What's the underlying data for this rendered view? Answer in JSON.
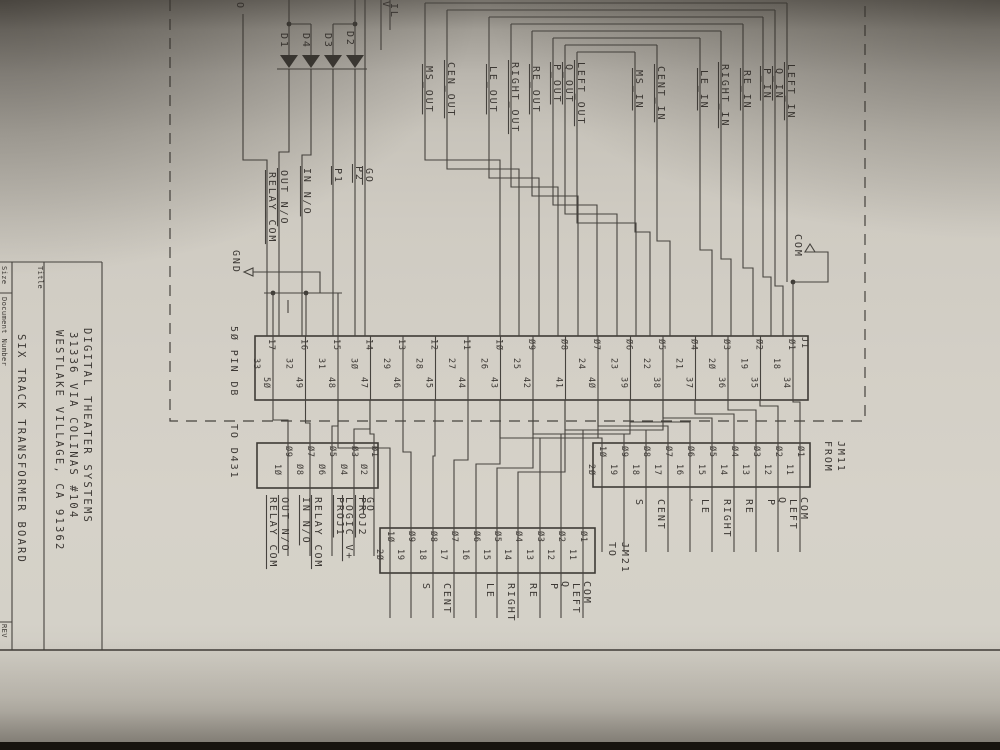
{
  "photo": {
    "paper_color": "#cfcbc2",
    "ink_color": "#45423e",
    "background_color": "#17140f"
  },
  "title_block": {
    "title_label": "Title",
    "size_label": "Size",
    "document_number_label": "Document Number",
    "rev_label": "REV",
    "company_line1": "DIGITAL THEATER SYSTEMS",
    "company_line2": "31336 VIA COLINAS #104",
    "company_line3": "WESTLAKE VILLAGE, CA 91362",
    "title": "SIX TRACK TRANSFORMER BOARD"
  },
  "edge_partial_labels": {
    "left": "O",
    "mid": "V",
    "right": "IL"
  },
  "power": {
    "gnd": "GND",
    "com": "COM"
  },
  "diodes": [
    "D1",
    "D4",
    "D3",
    "D2"
  ],
  "relay_nets": [
    "RELAY_COM",
    "OUT_N/O",
    "IN_N/O",
    "P1",
    "P2",
    "GO"
  ],
  "out_nets": [
    "MS_OUT",
    "CEN_OUT",
    "LE_OUT",
    "RIGHT_OUT",
    "RE_OUT",
    "P_OUT",
    "Q_OUT",
    "LEFT_OUT"
  ],
  "in_nets": [
    "MS_IN",
    "CENT_IN",
    "LE_IN",
    "RIGHT_IN",
    "RE_IN",
    "P_IN",
    "Q_IN",
    "LEFT_IN"
  ],
  "j1": {
    "designator": "J1",
    "type_label": "5Ø PIN DB",
    "to_label": "TO D431",
    "top_pins": [
      "17",
      "16",
      "15",
      "14",
      "13",
      "12",
      "11",
      "1Ø",
      "Ø9",
      "Ø8",
      "Ø7",
      "Ø6",
      "Ø5",
      "Ø4",
      "Ø3",
      "Ø2",
      "Ø1"
    ],
    "mid_pins": [
      "33",
      "32",
      "31",
      "3Ø",
      "29",
      "28",
      "27",
      "26",
      "25",
      "",
      "24",
      "23",
      "22",
      "21",
      "2Ø",
      "19",
      "18"
    ],
    "bot_pins": [
      "5Ø",
      "49",
      "48",
      "47",
      "46",
      "45",
      "44",
      "43",
      "42",
      "41",
      "4Ø",
      "39",
      "38",
      "37",
      "36",
      "35",
      "34"
    ]
  },
  "d431": {
    "upper_pins": [
      "Ø9",
      "Ø7",
      "Ø5",
      "Ø3",
      "Ø1"
    ],
    "lower_pins": [
      "1Ø",
      "Ø8",
      "Ø6",
      "Ø4",
      "Ø2"
    ],
    "net_labels": [
      "RELAY COM",
      "OUT N/O",
      "IN N/O",
      "RELAY COM",
      "PROJ1",
      "LOGIC V+",
      "PROJ2",
      "GO"
    ]
  },
  "jm11": {
    "caption1": "FROM",
    "caption2": "JM11",
    "upper_pins": [
      "1Ø",
      "Ø9",
      "Ø8",
      "Ø7",
      "Ø6",
      "Ø5",
      "Ø4",
      "Ø3",
      "Ø2",
      "Ø1"
    ],
    "lower_pins": [
      "2Ø",
      "19",
      "18",
      "17",
      "16",
      "15",
      "14",
      "13",
      "12",
      "11"
    ],
    "labels_left": [
      "",
      "",
      "S",
      "CENT",
      "",
      "LE",
      "RIGHT",
      "RE",
      "P",
      "LEFT"
    ],
    "labels_right": [
      "",
      "",
      "",
      "",
      ".",
      "",
      "",
      "",
      "Q",
      "COM"
    ]
  },
  "jm21": {
    "caption1": "TO",
    "caption2": "JM21",
    "upper_pins": [
      "1Ø",
      "Ø9",
      "Ø8",
      "Ø7",
      "Ø6",
      "Ø5",
      "Ø4",
      "Ø3",
      "Ø2",
      "Ø1"
    ],
    "lower_pins": [
      "2Ø",
      "19",
      "18",
      "17",
      "16",
      "15",
      "14",
      "13",
      "12",
      "11"
    ],
    "labels_left": [
      "",
      "",
      "S",
      "CENT",
      "",
      "LE",
      "RIGHT",
      "RE",
      "P",
      "LEFT"
    ],
    "labels_right": [
      "",
      "",
      "",
      "",
      "",
      "",
      "",
      "",
      "Q",
      "COM"
    ]
  }
}
